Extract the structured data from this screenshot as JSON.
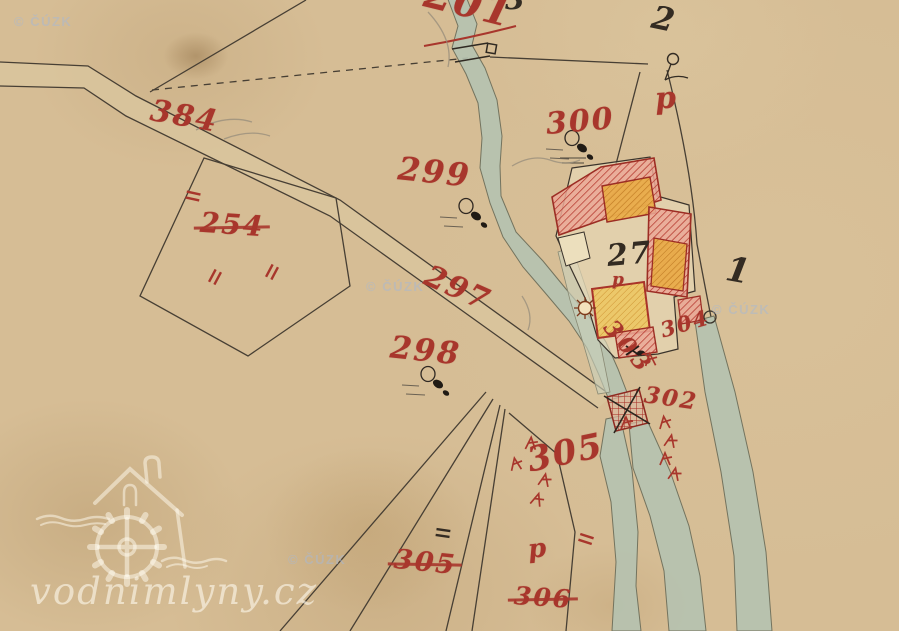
{
  "map": {
    "description": "hand-drawn historical cadastral map sheet of a watermill site",
    "palette": {
      "parchment": "#d6bd95",
      "water": "#b5c2b0",
      "ink_red": "#a8362c",
      "ink_black": "#332b22",
      "building_red_hatch": "#c04436",
      "building_orange": "#e7aa45",
      "building_yellow": "#ecc766"
    },
    "labels": [
      {
        "text": "201",
        "x": 424,
        "y": -16,
        "rot": 14,
        "size": 40,
        "color": "red"
      },
      {
        "text": "3",
        "x": 505,
        "y": -14,
        "rot": 0,
        "size": 28,
        "color": "black"
      },
      {
        "text": "2",
        "x": 652,
        "y": 3,
        "rot": 12,
        "size": 32,
        "color": "black"
      },
      {
        "text": "384",
        "x": 150,
        "y": 102,
        "rot": 10,
        "size": 30,
        "color": "red"
      },
      {
        "text": "254",
        "x": 200,
        "y": 211,
        "rot": 4,
        "size": 28,
        "color": "red",
        "strike": true
      },
      {
        "text": "299",
        "x": 398,
        "y": 156,
        "rot": 6,
        "size": 32,
        "color": "red"
      },
      {
        "text": "300",
        "x": 546,
        "y": 107,
        "rot": -5,
        "size": 30,
        "color": "red"
      },
      {
        "text": "297",
        "x": 423,
        "y": 274,
        "rot": 24,
        "size": 30,
        "color": "red"
      },
      {
        "text": "298",
        "x": 390,
        "y": 336,
        "rot": 6,
        "size": 31,
        "color": "red"
      },
      {
        "text": "27",
        "x": 607,
        "y": 240,
        "rot": -5,
        "size": 30,
        "color": "black"
      },
      {
        "text": "1",
        "x": 726,
        "y": 254,
        "rot": 10,
        "size": 34,
        "color": "black"
      },
      {
        "text": "p",
        "x": 655,
        "y": 84,
        "rot": -4,
        "size": 30,
        "color": "red"
      },
      {
        "text": "p",
        "x": 612,
        "y": 272,
        "rot": 0,
        "size": 17,
        "color": "red"
      },
      {
        "text": "304",
        "x": 660,
        "y": 313,
        "rot": -16,
        "size": 21,
        "color": "red"
      },
      {
        "text": "303",
        "x": 597,
        "y": 336,
        "rot": 50,
        "size": 23,
        "color": "red",
        "ls": 5
      },
      {
        "text": "302",
        "x": 644,
        "y": 387,
        "rot": 8,
        "size": 23,
        "color": "red"
      },
      {
        "text": "305",
        "x": 527,
        "y": 436,
        "rot": -12,
        "size": 34,
        "color": "red"
      },
      {
        "text": "305",
        "x": 394,
        "y": 549,
        "rot": 6,
        "size": 27,
        "color": "red",
        "strike": true
      },
      {
        "text": "306",
        "x": 514,
        "y": 585,
        "rot": 4,
        "size": 25,
        "color": "red",
        "strike": true
      },
      {
        "text": "p",
        "x": 528,
        "y": 536,
        "rot": -6,
        "size": 26,
        "color": "red"
      }
    ],
    "boundary_marks": [
      {
        "color": "red",
        "x": 193,
        "y": 196,
        "rot": 12
      },
      {
        "color": "red",
        "x": 215,
        "y": 277,
        "rot": -62
      },
      {
        "color": "red",
        "x": 272,
        "y": 272,
        "rot": -62
      },
      {
        "color": "red",
        "x": 586,
        "y": 539,
        "rot": 18
      },
      {
        "color": "black",
        "x": 443,
        "y": 533,
        "rot": 8
      }
    ],
    "survey_arrows": [
      {
        "x": 510,
        "y": 462,
        "rot": -10
      },
      {
        "x": 526,
        "y": 440,
        "rot": 4
      },
      {
        "x": 540,
        "y": 476,
        "rot": 12
      },
      {
        "x": 533,
        "y": 495,
        "rot": 18
      },
      {
        "x": 621,
        "y": 420,
        "rot": 0
      },
      {
        "x": 659,
        "y": 420,
        "rot": -6
      },
      {
        "x": 666,
        "y": 437,
        "rot": 12
      },
      {
        "x": 660,
        "y": 456,
        "rot": 0
      },
      {
        "x": 670,
        "y": 470,
        "rot": 12
      },
      {
        "x": 645,
        "y": 357,
        "rot": -4
      }
    ],
    "tree_symbols": [
      {
        "x": 466,
        "y": 206
      },
      {
        "x": 572,
        "y": 138
      },
      {
        "x": 428,
        "y": 374
      }
    ]
  },
  "watermarks": {
    "cuzk_text": "© ČÚZK",
    "cuzk_positions": [
      {
        "x": 14,
        "y": 14
      },
      {
        "x": 366,
        "y": 279
      },
      {
        "x": 712,
        "y": 302
      },
      {
        "x": 288,
        "y": 552
      }
    ],
    "site_text": "vodnimlyny.cz"
  }
}
